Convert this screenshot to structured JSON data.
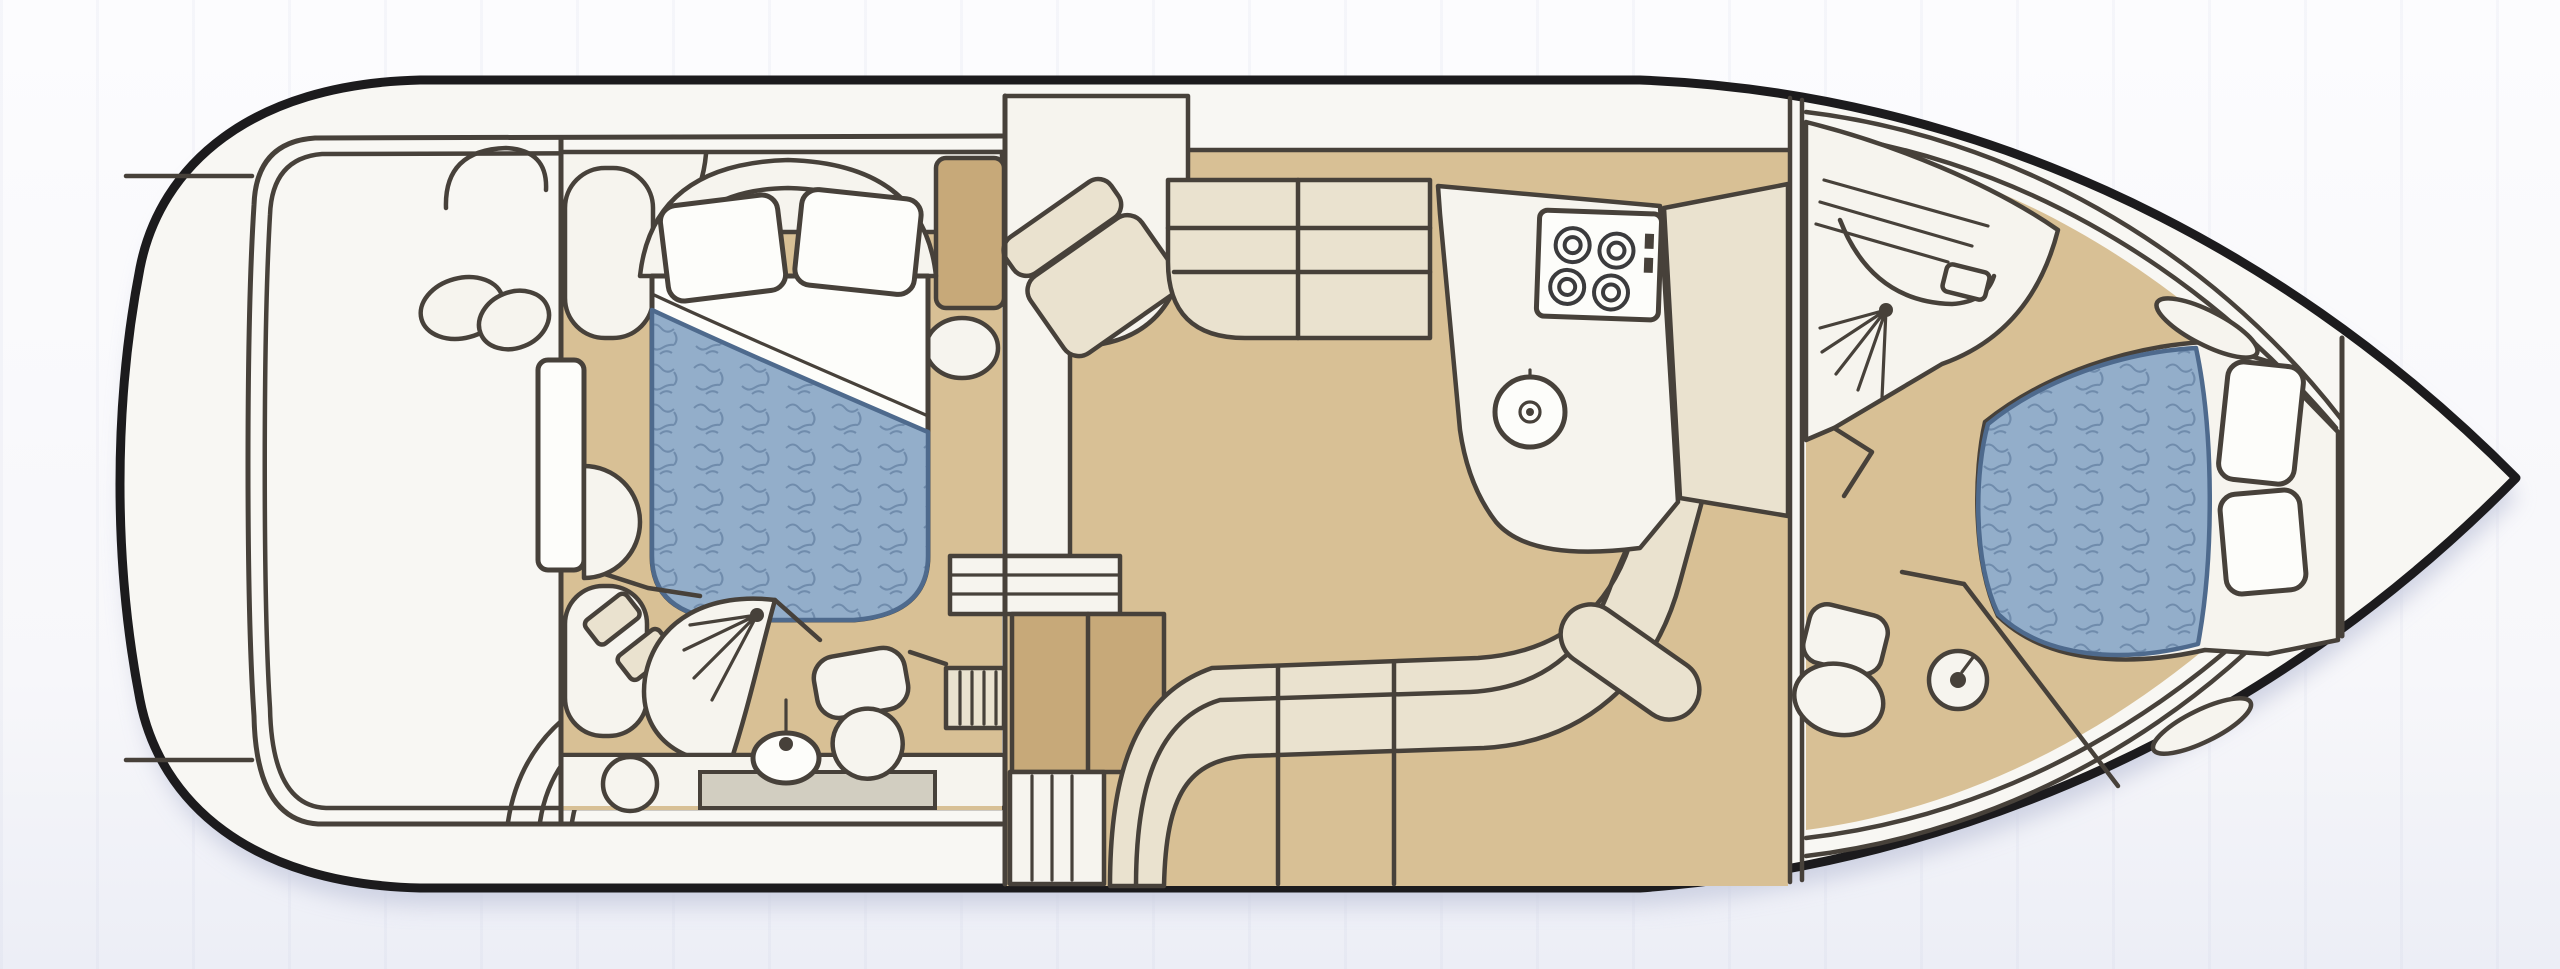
{
  "diagram": {
    "type": "floor-plan",
    "subject": "motor-yacht-lower-deck-plan",
    "orientation": "bow-right-stern-left-top-view",
    "colors": {
      "background": "#fafafc",
      "shadow": "#c8ccdf",
      "hull_outline": "#1c1b1d",
      "line": "#47413a",
      "hull_white": "#f8f7f3",
      "room_white": "#f6f4ee",
      "floor_tan": "#d8c095",
      "cabinet_tan": "#c7a979",
      "furniture_cream": "#eae2cf",
      "step_grey": "#d2cec1",
      "bed_blue": "#93aeca",
      "bed_blue_dark": "#4e6a8d",
      "pillow_white": "#fdfdfa",
      "burner": "#3b3b3d"
    },
    "rooms": [
      {
        "name": "swim-platform"
      },
      {
        "name": "cockpit"
      },
      {
        "name": "aft-cabin"
      },
      {
        "name": "aft-head"
      },
      {
        "name": "salon"
      },
      {
        "name": "galley"
      },
      {
        "name": "forward-head"
      },
      {
        "name": "forward-cabin"
      },
      {
        "name": "foredeck"
      }
    ],
    "features": [
      "double-bed-aft-with-blue-duvet",
      "two-pillows-aft",
      "headboard-arch",
      "dressing-table",
      "wardrobe",
      "shower-aft",
      "toilet-aft",
      "sink-aft",
      "companionway-steps",
      "armchair",
      "sofa-two-seat",
      "l-shaped-settee",
      "galley-stove-4-burners",
      "galley-sink",
      "galley-counter",
      "forward-shower",
      "forward-toilet",
      "forward-sink",
      "island-bed-forward-with-blue-duvet",
      "two-pillows-forward",
      "hull-side-windows",
      "bow-bulkhead",
      "deck-side-bands"
    ]
  }
}
